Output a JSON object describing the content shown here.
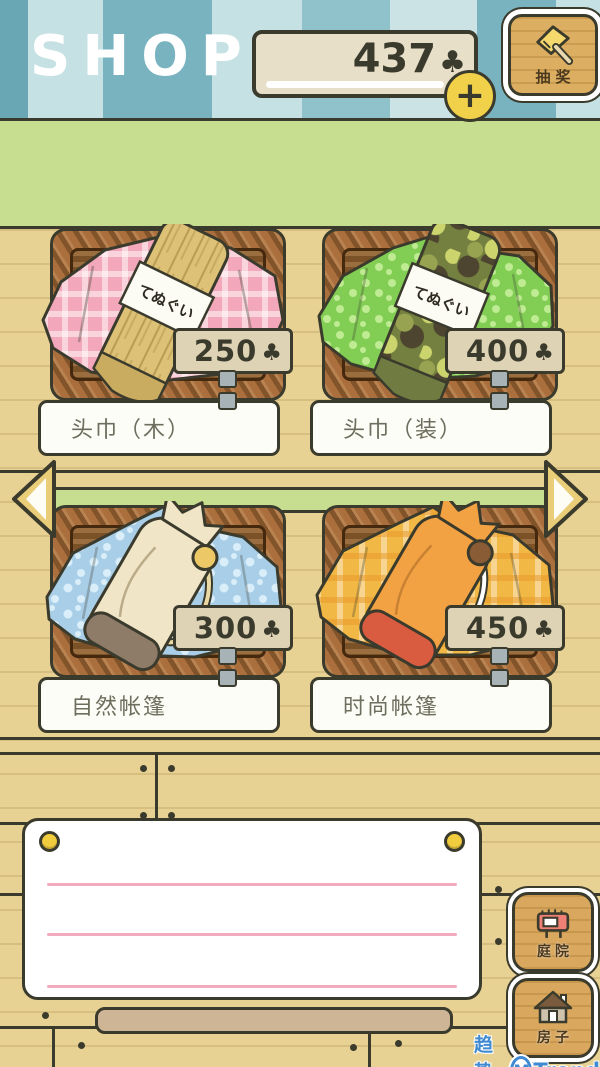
{
  "header": {
    "title": "SHOP",
    "balance": "437",
    "add_label": "+",
    "lottery_label": "抽奖"
  },
  "currency": {
    "symbol": "♣"
  },
  "shop": {
    "items": [
      {
        "name": "头巾（木）",
        "price": "250",
        "band_text": "てぬぐい"
      },
      {
        "name": "头巾（装）",
        "price": "400",
        "band_text": "てぬぐい"
      },
      {
        "name": "自然帐篷",
        "price": "300"
      },
      {
        "name": "时尚帐篷",
        "price": "450"
      }
    ]
  },
  "nav": {
    "courtyard_label": "庭院",
    "house_label": "房子"
  },
  "watermark": {
    "site": "趋势网",
    "logo_letter": "M",
    "brand": "Trend"
  }
}
